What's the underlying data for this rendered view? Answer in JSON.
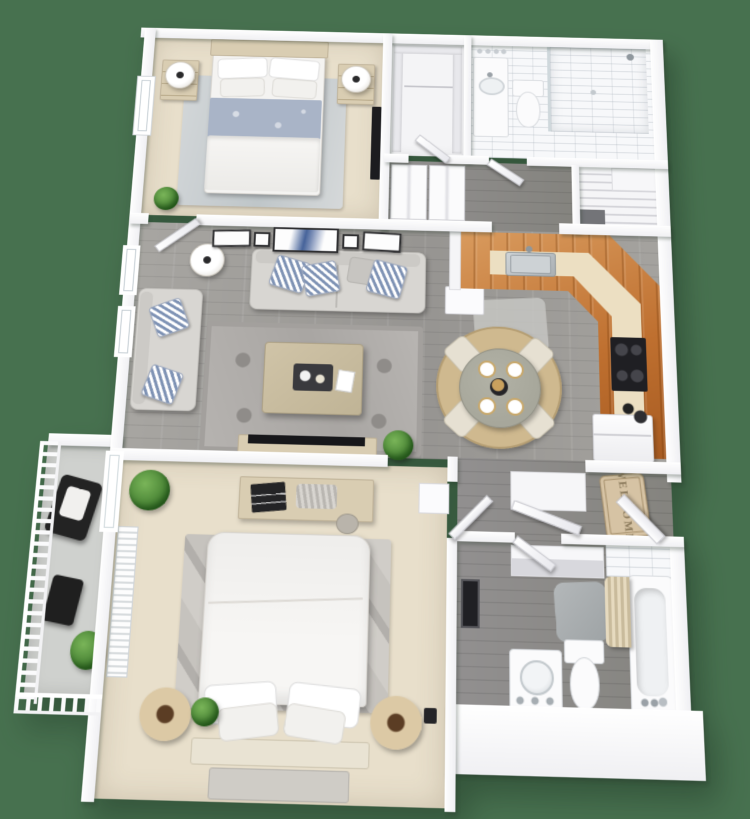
{
  "image": {
    "kind": "3d-floor-plan-rendering",
    "view": "top-down dollhouse perspective",
    "background_color": "#47714F",
    "bedrooms": 2,
    "bathrooms": 2
  },
  "welcome_mat": {
    "text": "WELCOME"
  },
  "palette": {
    "bg": "#47714F",
    "wall": "#f0f0f3",
    "wood-floor": "#a3a19d",
    "wood-floor-dark": "#908f8c",
    "carpet": "#e8dfcb",
    "white-floor": "#f4f4f6",
    "cabinet-wood": "#bf7030",
    "bar-wood": "#d99b5e",
    "countertop": "#ecdfc2",
    "steel": "#b9bec2",
    "black": "#222326",
    "sofa": "#d8d6d2",
    "pillow-blue": "#7e92b4",
    "rug-gray": "#b4b1ae",
    "rug-bed": "#cbc8c3",
    "jute": "#cfb98f",
    "table-top": "#a7a79b",
    "chair-cream": "#e6e0d2",
    "bed-white": "#f4f3f1",
    "blanket-blue": "#a9b4c7",
    "wood-furn": "#d9cdb2",
    "green-dark": "#3f7a2e",
    "green-light": "#7ab559",
    "mat-tan": "#d6c3a4",
    "mat-text": "#8b7a5c",
    "concrete": "#cfd1ce",
    "porcelain": "#fbfbfc",
    "glass": "#cfd8dc"
  },
  "rooms": [
    {
      "id": "bedroom-1",
      "position": "top-left",
      "flooring": "carpet",
      "furniture": [
        "bed with blue-and-white bedding",
        "two nightstands",
        "two table lamps",
        "area rug",
        "wall mirror",
        "plant",
        "window"
      ]
    },
    {
      "id": "walk-in-closet",
      "position": "top-center",
      "flooring": "white",
      "furniture": [
        "shelving",
        "hanging rod"
      ]
    },
    {
      "id": "bathroom-1",
      "position": "top-right",
      "flooring": "tile",
      "furniture": [
        "vanity with sink and mirror lights",
        "toilet",
        "walk-in shower"
      ]
    },
    {
      "id": "staircase",
      "position": "right",
      "furniture": [
        "landing",
        "steps descending"
      ]
    },
    {
      "id": "hallway",
      "position": "center",
      "flooring": "wood",
      "furniture": [
        "two bifold-door closets"
      ]
    },
    {
      "id": "living-room",
      "position": "middle-left",
      "flooring": "gray wood planks",
      "furniture": [
        "sofa with striped pillows",
        "loveseat with striped pillows",
        "floor lamp",
        "patterned area rug",
        "coffee table with tray",
        "tv console",
        "five wall art frames",
        "plant",
        "two windows"
      ]
    },
    {
      "id": "kitchen",
      "position": "middle-right",
      "flooring": "gray wood planks",
      "furniture": [
        "L-shaped wood cabinet counter with angled corner",
        "stainless sink",
        "stove with four burners",
        "refrigerator",
        "dishwasher",
        "kitchen mat"
      ]
    },
    {
      "id": "dining-nook",
      "position": "center-right",
      "furniture": [
        "round jute rug",
        "round dining table with four place settings",
        "four cream chairs",
        "centerpiece"
      ]
    },
    {
      "id": "entry",
      "position": "right",
      "flooring": "wood",
      "furniture": [
        "front door",
        "welcome mat",
        "coat closet with open door"
      ]
    },
    {
      "id": "balcony",
      "position": "bottom-left",
      "flooring": "concrete",
      "furniture": [
        "white railing",
        "black patio chair with cushion",
        "black side table",
        "plant"
      ]
    },
    {
      "id": "bedroom-2",
      "position": "bottom-center",
      "flooring": "carpet",
      "furniture": [
        "bed with white bedding",
        "gray area rug",
        "dresser with decor",
        "two round basket nightstands",
        "bench",
        "window blinds",
        "two plants",
        "wall cabinet"
      ]
    },
    {
      "id": "bathroom-2",
      "position": "bottom-right",
      "flooring": "wood",
      "furniture": [
        "linen shelves",
        "leaning mirror",
        "vanity with round sink",
        "toilet",
        "gray bath mat",
        "bathtub with shower curtain",
        "tile surround"
      ]
    }
  ]
}
